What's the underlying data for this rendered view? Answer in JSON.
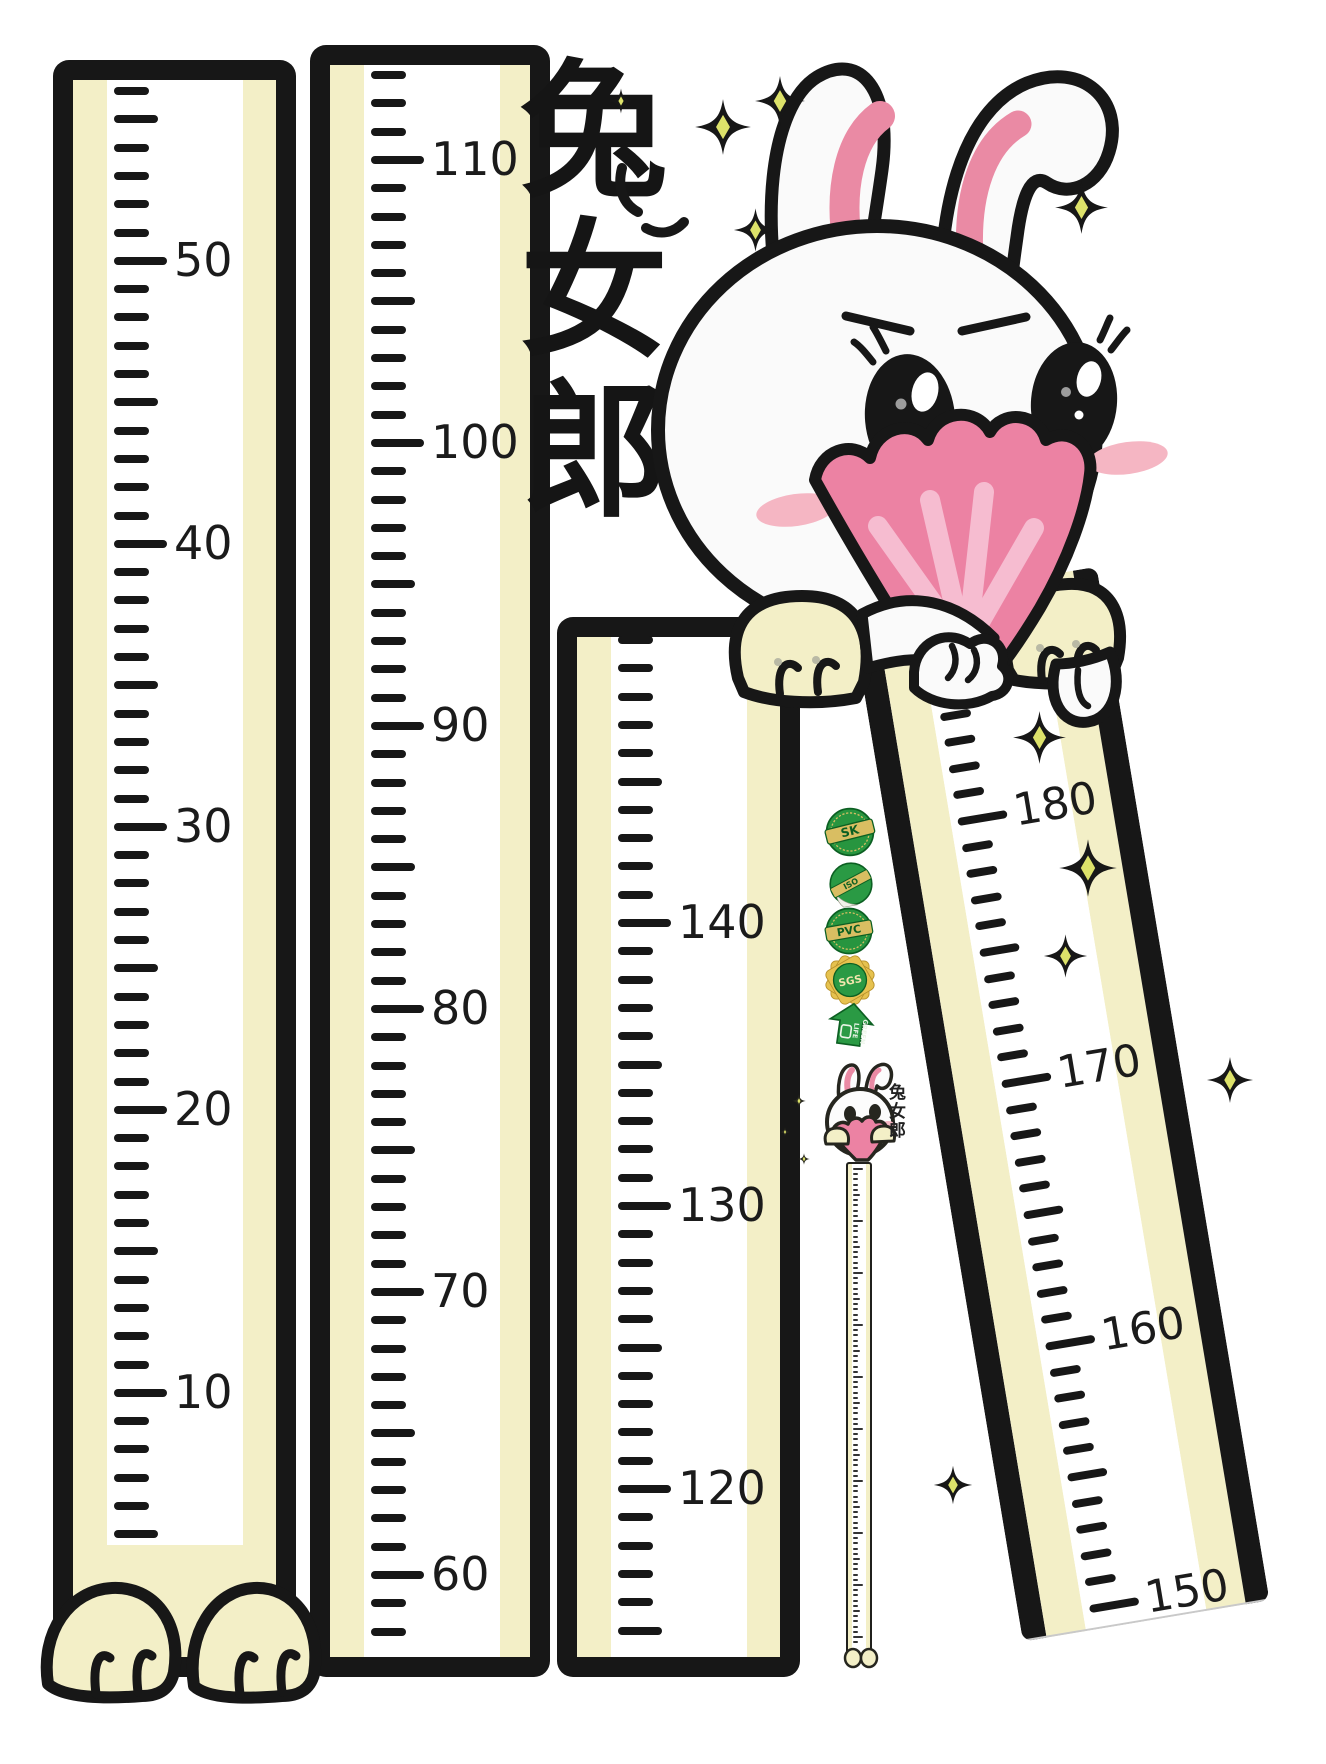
{
  "title": {
    "text": "兔女郎"
  },
  "rulers": {
    "segment_1": {
      "labels": [
        "50",
        "40",
        "30",
        "20",
        "10"
      ]
    },
    "segment_2": {
      "labels": [
        "110",
        "100",
        "90",
        "80",
        "70",
        "60"
      ]
    },
    "segment_3": {
      "labels": [
        "140",
        "130",
        "120"
      ]
    },
    "segment_4": {
      "labels": [
        "180",
        "170",
        "160",
        "150"
      ]
    }
  },
  "badges": [
    {
      "label": "SK"
    },
    {
      "label": "ISO"
    },
    {
      "label": "PVC"
    },
    {
      "label": "SGS"
    },
    {
      "line1": "GREEN",
      "line2": "LIFE"
    }
  ],
  "preview": {
    "title": "兔女郎"
  },
  "colors": {
    "cream": "#f3efc7",
    "outline": "#171717",
    "pink": "#ec82a3",
    "pink_light": "#f6bcd0",
    "blush": "#f5b6c3",
    "sparkle_yellow": "#dde26a",
    "badge_green": "#2a9a44",
    "badge_gold": "#d9be62"
  }
}
